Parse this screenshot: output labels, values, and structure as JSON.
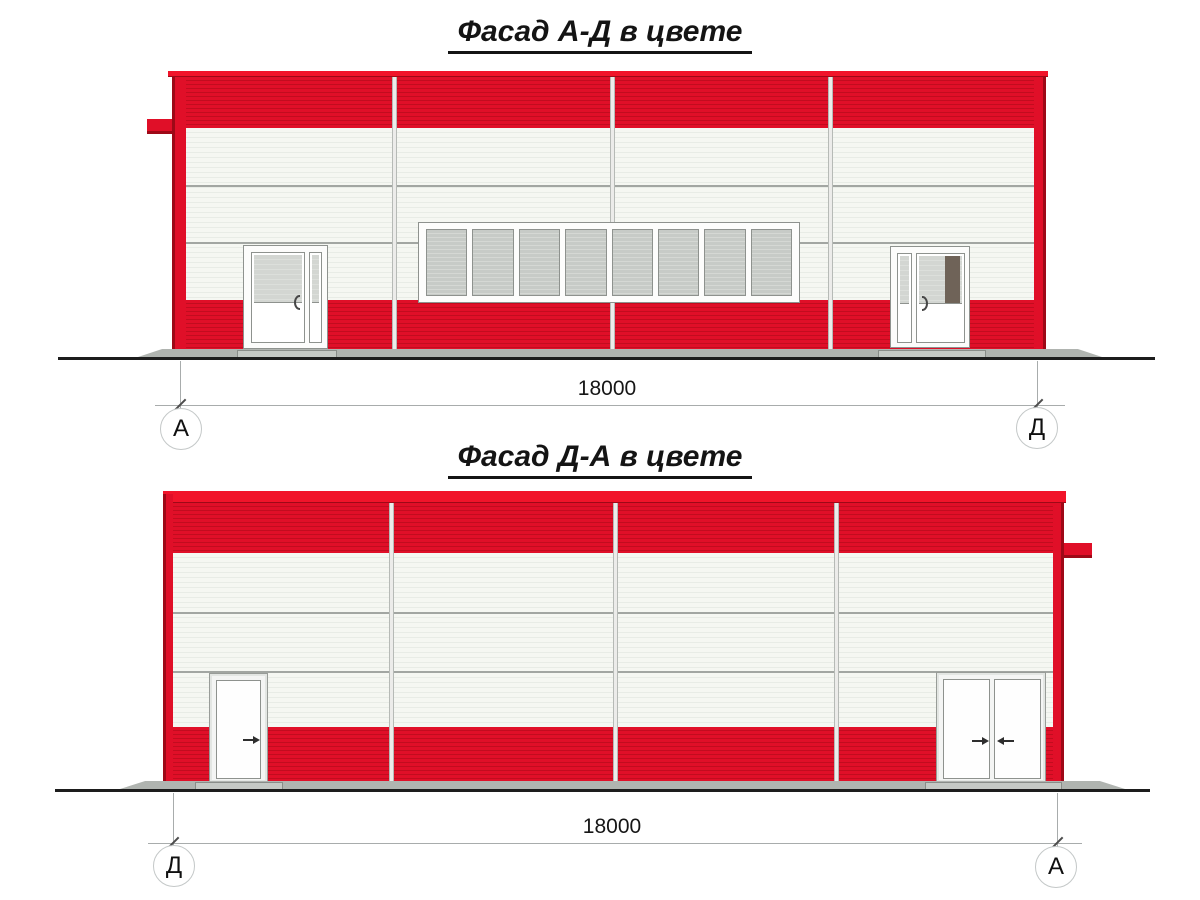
{
  "views": {
    "facade_ad": {
      "title": "Фасад А-Д в цвете",
      "dimension_label": "18000",
      "axis_left_label": "А",
      "axis_right_label": "Д",
      "window_pane_count": 8
    },
    "facade_da": {
      "title": "Фасад Д-А в цвете",
      "dimension_label": "18000",
      "axis_left_label": "Д",
      "axis_right_label": "А"
    }
  },
  "icons": {
    "door_handle": "door-handle-arc",
    "door_swing": "door-swing-arrow"
  },
  "colors": {
    "red_band": "#e00f28",
    "red_stripe": "#c20c1f",
    "red_coping": "#f1142a",
    "red_dark": "#9e0917",
    "panel_white": "#f5f7f2",
    "panel_stripe": "#e8ece6",
    "joint_strip": "#ececea",
    "joint_border": "#b6bab6",
    "joint_line": "#a2a6a2",
    "glass": "#c7cbc7",
    "glass_stripe": "#d5d8d4",
    "door_glass": "#d3d6d2",
    "door_glass_stripe": "#dcdfdb",
    "frame_border": "#8e928e",
    "dark_brown": "#6f6358",
    "apron": "#b0b4b0",
    "threshold": "#c5c9c5",
    "ground_line": "#1d1d1d",
    "dim_line": "#a8acac",
    "circle_border": "#c4c8c8"
  }
}
